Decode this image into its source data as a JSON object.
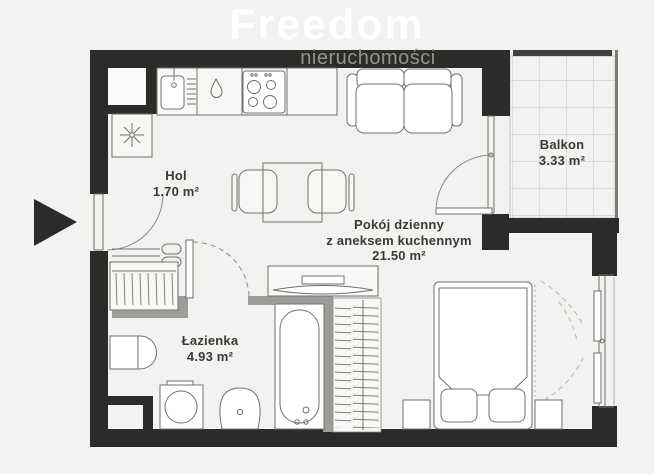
{
  "watermark": {
    "brand": "Freedom",
    "subtitle": "nieruchomości"
  },
  "rooms": {
    "hol": {
      "name": "Hol",
      "area": "1.70 m²"
    },
    "living": {
      "name_line1": "Pokój dzienny",
      "name_line2": "z aneksem kuchennym",
      "area": "21.50 m²"
    },
    "bathroom": {
      "name": "Łazienka",
      "area": "4.93 m²"
    },
    "balcony": {
      "name": "Balkon",
      "area": "3.33 m²"
    }
  },
  "colors": {
    "background": "#f2f2f0",
    "wall": "#2d2b29",
    "partition_wall": "#9e9c99",
    "outline": "#71706d",
    "label_text": "#3b3936",
    "watermark_brand": "#ffffff",
    "watermark_subtitle": "#96948f"
  },
  "fixtures": [
    "entrance-arrow",
    "entrance-door",
    "kitchen-counter",
    "kitchen-sink",
    "gas-point-symbol",
    "cooktop",
    "boiler-closet",
    "ventilation-shaft",
    "hall-shelf",
    "hall-wardrobe",
    "dining-table",
    "dining-chairs",
    "sofa",
    "balcony-door",
    "balcony-floor-tiles",
    "bathroom-door",
    "bathroom-sink",
    "washing-machine",
    "toilet",
    "bathtub",
    "tv-unit",
    "bedroom-wardrobe",
    "double-bed",
    "nightstands",
    "bedroom-window",
    "curtains"
  ]
}
